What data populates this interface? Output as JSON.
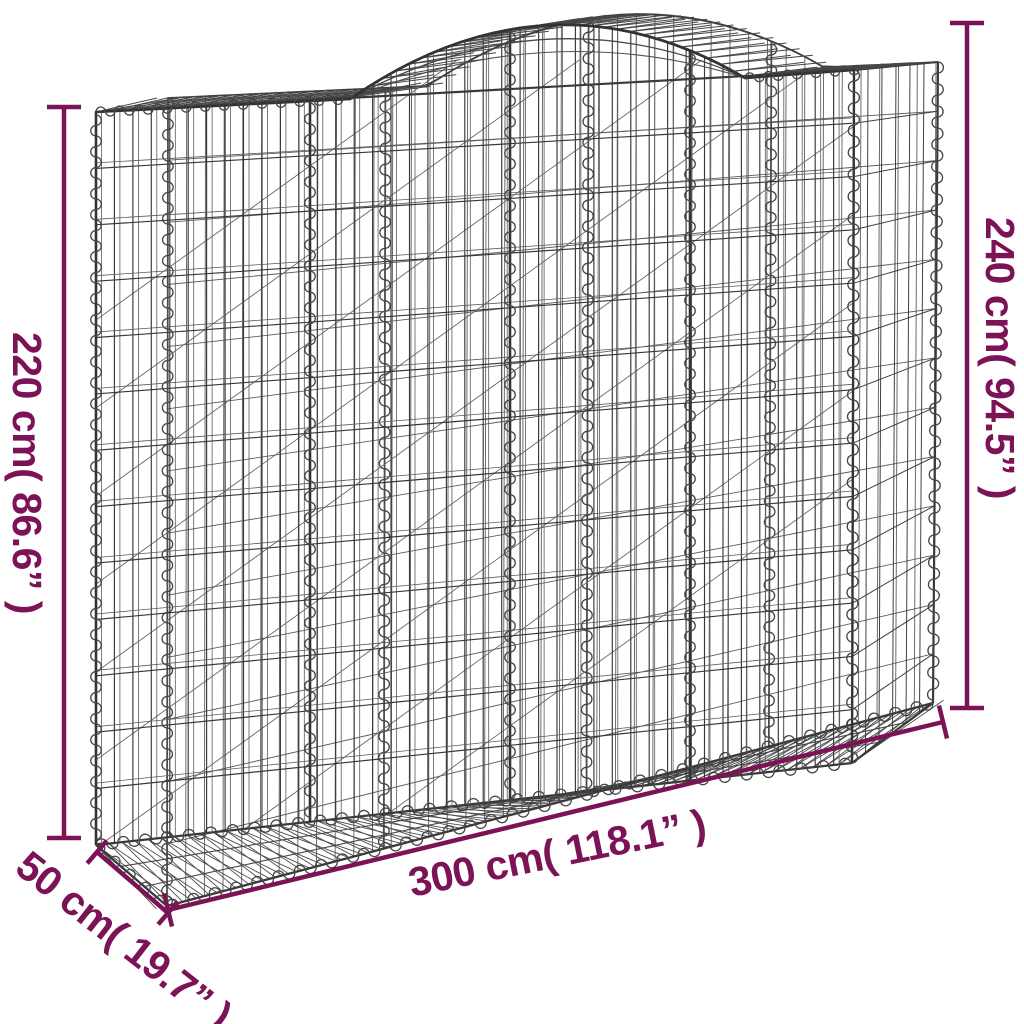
{
  "page": {
    "background": "#ffffff"
  },
  "drawing": {
    "subject": "arched-gabion-wire-mesh-basket",
    "wire_color": "#3a3a3a",
    "wire_color_light": "#5c5c5c",
    "accent_color": "#7b1356"
  },
  "dimensions": {
    "height_left": {
      "label": "220 cm( 86.6” )"
    },
    "height_right": {
      "label": "240 cm( 94.5” )"
    },
    "width_bottom": {
      "label": "300 cm( 118.1” )"
    },
    "depth_left": {
      "label": "50 cm( 19.7” )"
    }
  }
}
